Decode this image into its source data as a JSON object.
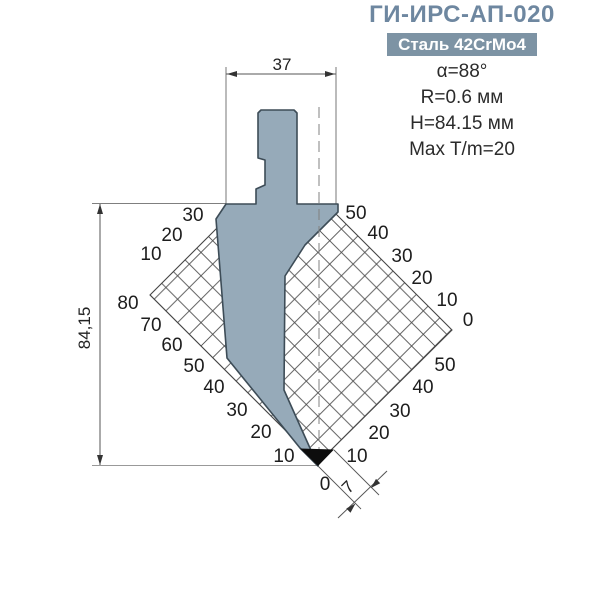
{
  "header": {
    "title": "ГИ-ИРС-АП-020",
    "badge": "Сталь 42CrMo4",
    "specs": {
      "angle": "α=88°",
      "radius": "R=0.6 мм",
      "height": "H=84.15 мм",
      "tonnage": "Max T/m=20"
    }
  },
  "dimensions": {
    "top_width": "37",
    "left_height": "84,15",
    "tip_offset": "7"
  },
  "grid": {
    "upper_left": [
      "30",
      "20",
      "10"
    ],
    "lower_left": [
      "80",
      "70",
      "60",
      "50",
      "40",
      "30",
      "20",
      "10"
    ],
    "bottom_zero": "0",
    "upper_right": [
      "50",
      "40",
      "30",
      "20",
      "10",
      "0"
    ],
    "lower_right": [
      "50",
      "40",
      "30",
      "20",
      "10"
    ]
  },
  "colors": {
    "title_text": "#6e87a0",
    "badge_background": "#7d93a4",
    "badge_text": "#ffffff",
    "punch_fill": "#96aab9",
    "punch_outline": "#3d4c57",
    "tip_fill": "#0d0d0d",
    "grid_lines": "#4f4f4f",
    "dimension_lines": "#555555",
    "background": "#ffffff"
  }
}
